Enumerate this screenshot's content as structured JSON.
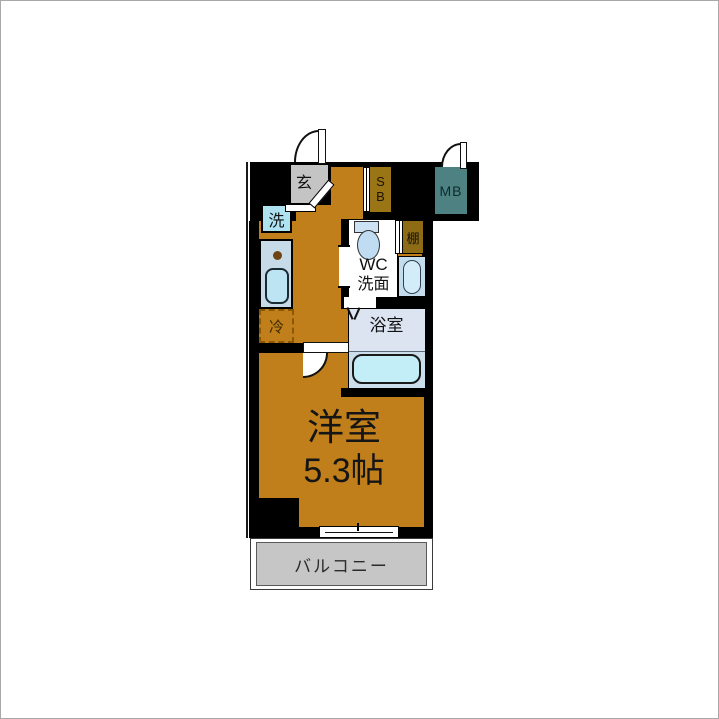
{
  "entrance": {
    "label": "玄"
  },
  "shoe_box": {
    "line1": "S",
    "line2": "B"
  },
  "meter_box": {
    "label": "MB"
  },
  "fixtures": {
    "washer_label": "洗",
    "fridge_label": "冷",
    "shelf_label": "棚"
  },
  "toilet_room": {
    "line1": "WC",
    "line2": "洗面"
  },
  "bathroom": {
    "label": "浴室"
  },
  "main_room": {
    "name": "洋室",
    "size": "5.3帖"
  },
  "balcony": {
    "label": "バルコニー"
  },
  "colors": {
    "floor_orange": "#C07F1A",
    "wall_black": "#000000",
    "entrance_gray": "#C4C4C4",
    "shoe_box_olive": "#9A7516",
    "shelf_olive": "#8E6C15",
    "meter_box_teal": "#4E8181",
    "balcony_gray": "#C6C6C6",
    "kitchen_counter_blue": "#C7DAE8",
    "washer_blue": "#AEE2F0",
    "sink_blue": "#BCE4F2",
    "toilet_blue": "#BFDCF2",
    "bath_lavender": "#DCE4F2",
    "tub_cyan": "#C3EEF8"
  }
}
